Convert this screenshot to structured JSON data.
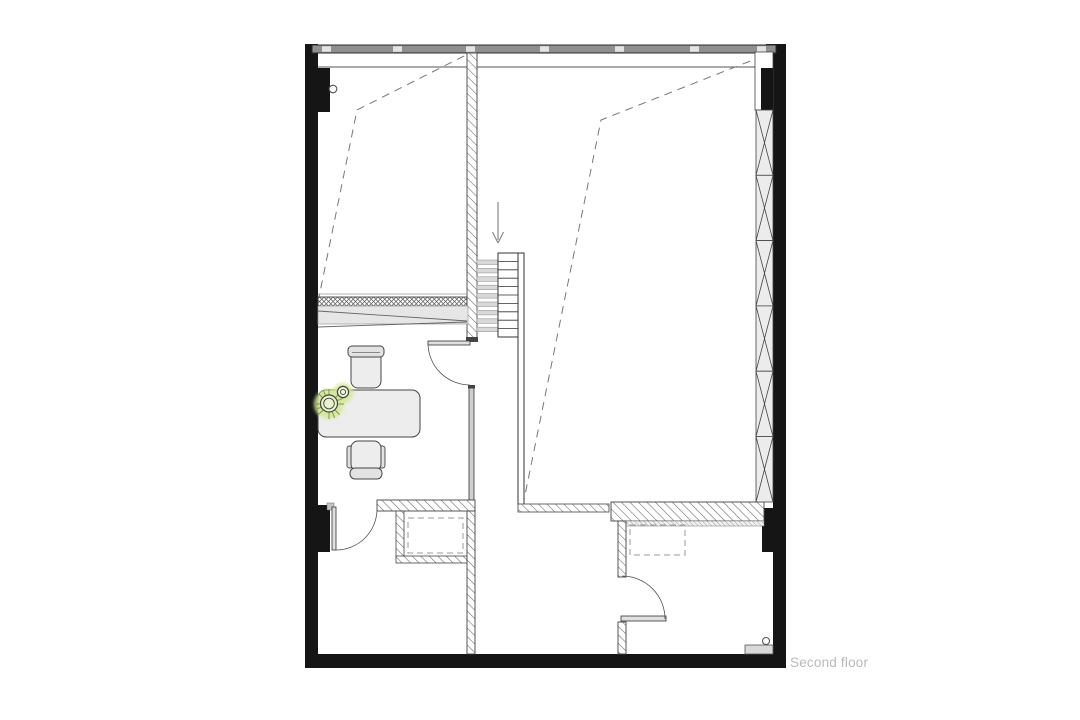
{
  "plan": {
    "floor_label": "Second floor",
    "stair_direction": "down"
  },
  "colors": {
    "wall_black": "#151515",
    "line_dark": "#333333",
    "hatch_gray": "#666666",
    "window_band_gray": "#8f8f8f",
    "furniture_fill": "#ededed",
    "plant_glow_green": "#d3e795",
    "plant_stem_green": "#7d9c42",
    "label_gray": "#b9b9b9"
  }
}
